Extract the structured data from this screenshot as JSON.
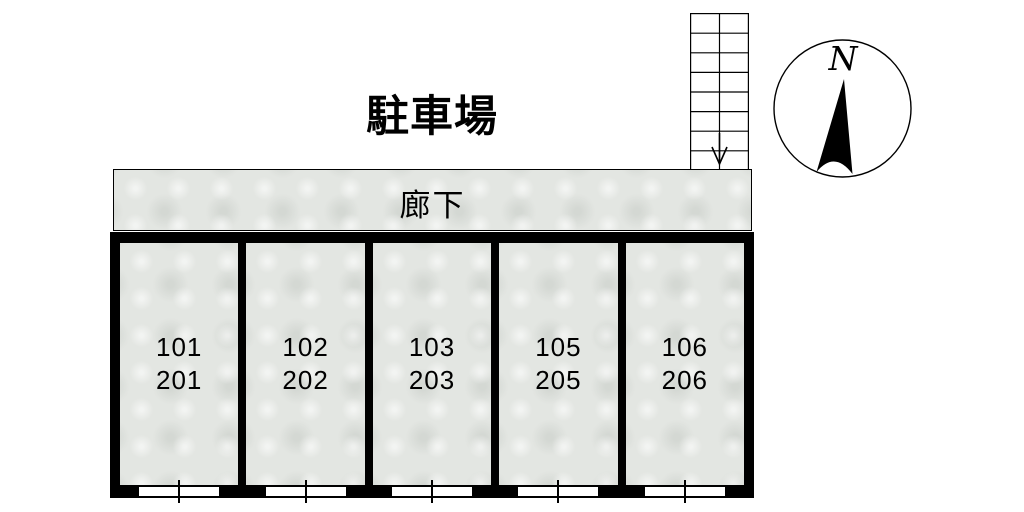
{
  "title": {
    "text": "駐車場"
  },
  "corridor": {
    "label": "廊下"
  },
  "stairs": {
    "steps": 8,
    "arrow_direction": "down"
  },
  "compass": {
    "direction_label": "N"
  },
  "rooms": [
    {
      "floor1": "101",
      "floor2": "201"
    },
    {
      "floor1": "102",
      "floor2": "202"
    },
    {
      "floor1": "103",
      "floor2": "203"
    },
    {
      "floor1": "105",
      "floor2": "205"
    },
    {
      "floor1": "106",
      "floor2": "206"
    }
  ],
  "colors": {
    "wall": "#000000",
    "floor_fill": "#e3e6e2",
    "background": "#ffffff",
    "line": "#000000"
  }
}
